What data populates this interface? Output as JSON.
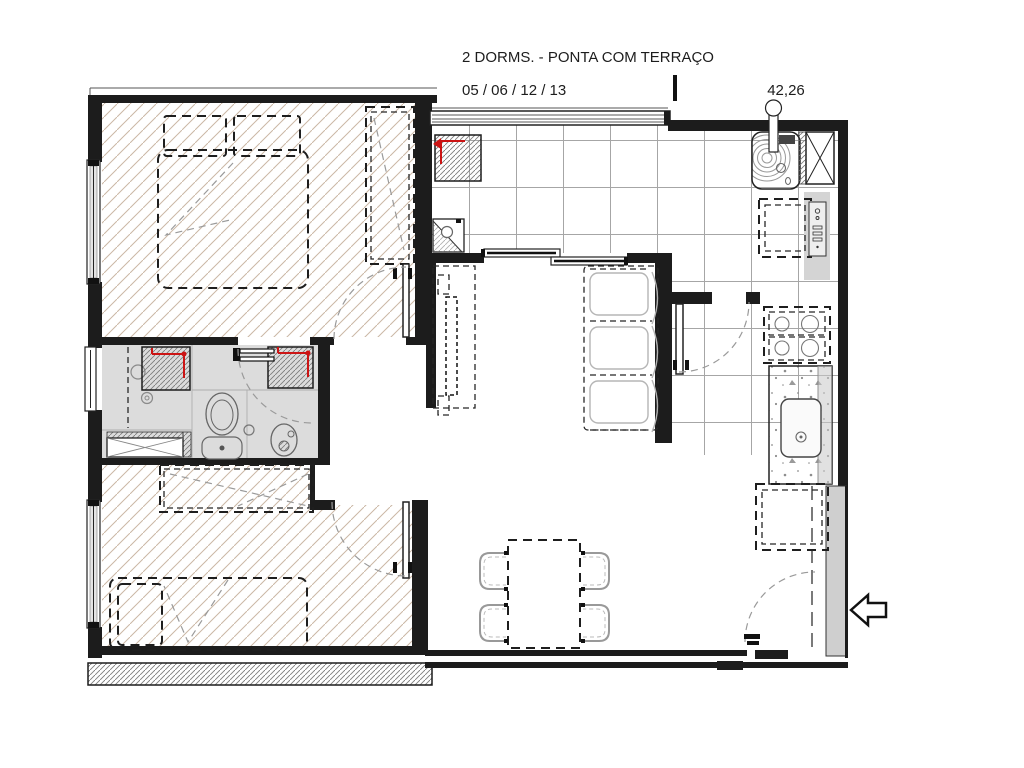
{
  "header": {
    "title": "2 DORMS. - PONTA COM TERRAÇO",
    "unit_numbers": "05 / 06 / 12 / 13",
    "area": "42,26"
  },
  "plan": {
    "kind": "apartment-floor-plan",
    "rooms": [
      "bedroom-1",
      "bedroom-2",
      "bathroom",
      "kitchen",
      "living-dining",
      "entrance-terrace"
    ],
    "symbols": [
      "double-bed",
      "single-bed",
      "wardrobe",
      "shower",
      "toilet",
      "washbasin",
      "bidet",
      "kitchen-sink",
      "stove",
      "fridge",
      "laundry-counter",
      "sofa",
      "tv-unit",
      "dining-table",
      "dining-chairs",
      "sliding-door",
      "entrance-arrow-icon"
    ]
  },
  "colors": {
    "wall": "#1c1c1c",
    "room_hatch": "#cbb7a5",
    "duct_hatch": "#7d7d7d",
    "tile_line": "#a6a6a6",
    "fixture_gray": "#dcdcdc",
    "wall_gray": "#cfcfcf",
    "red_accent": "#cc1414"
  }
}
